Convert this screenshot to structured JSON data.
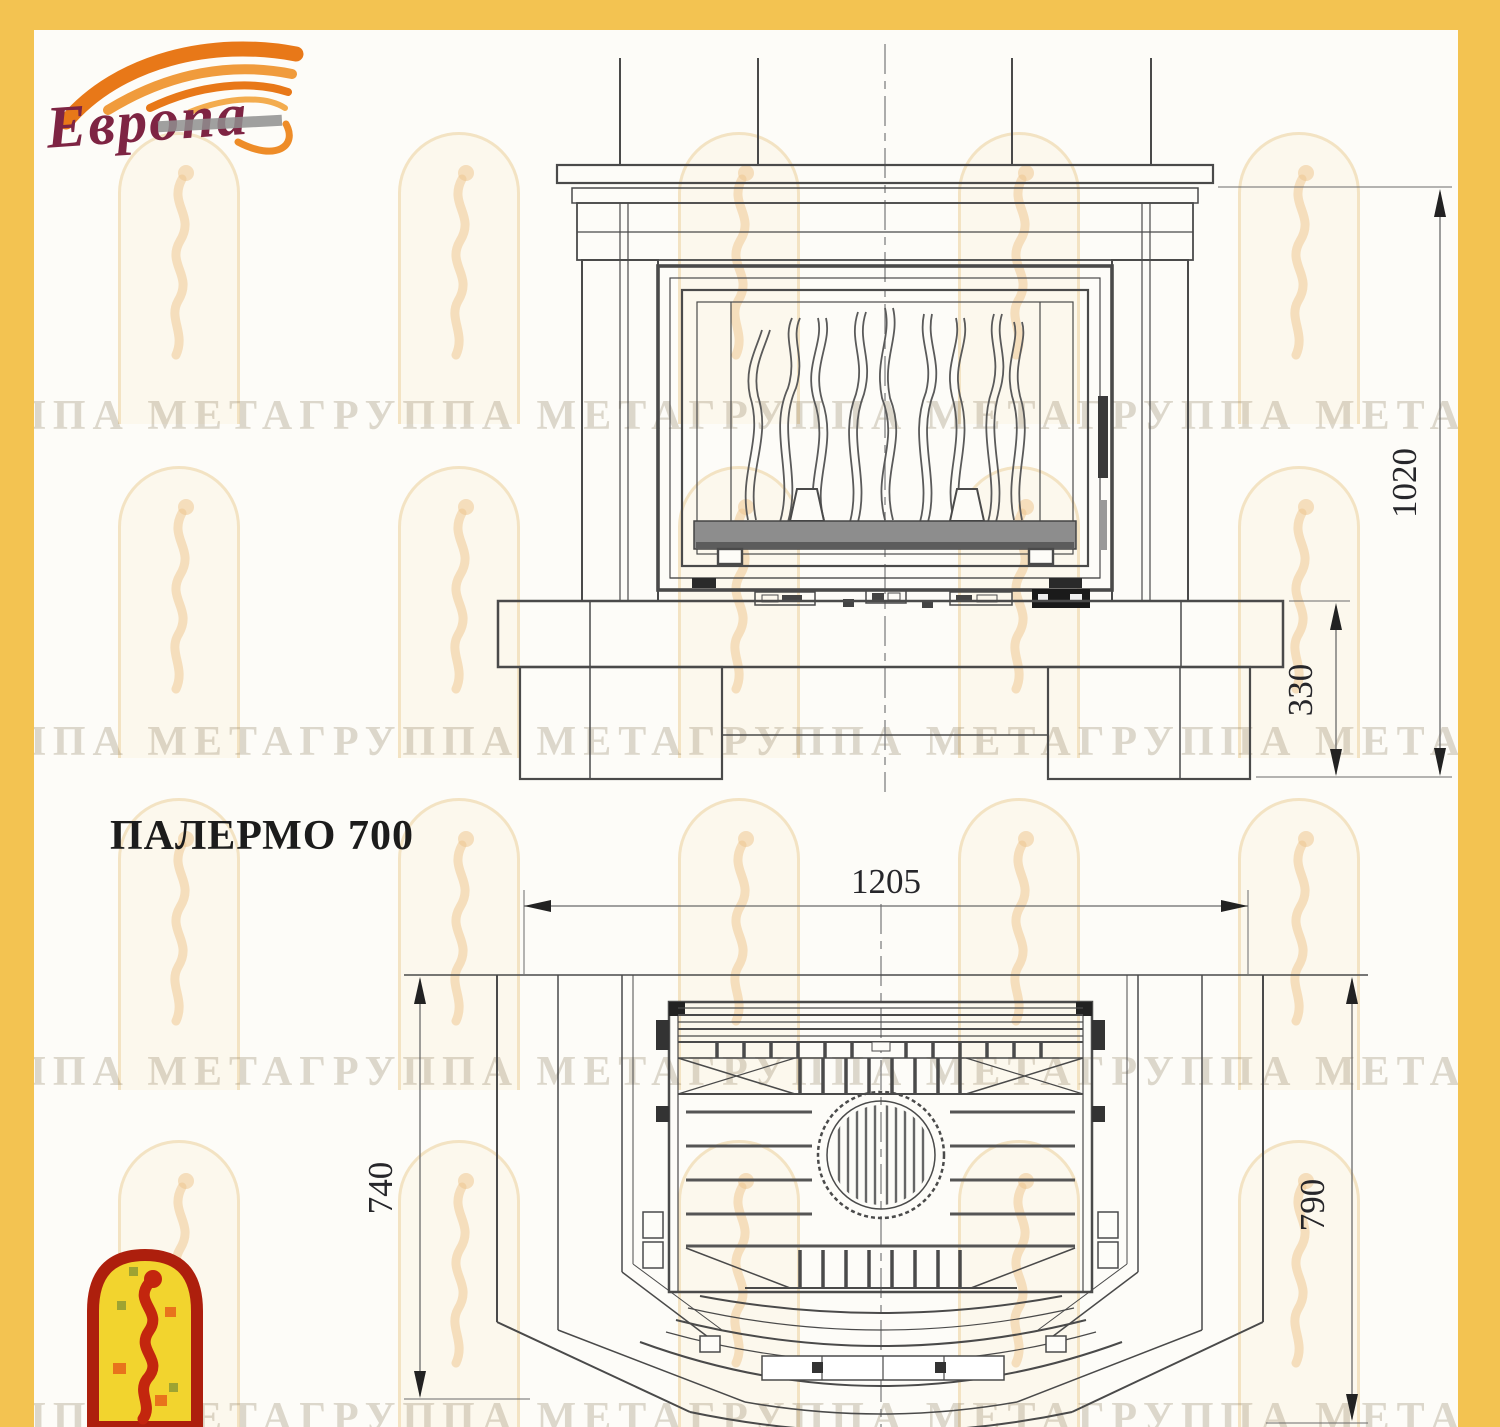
{
  "page": {
    "background": "#FDFCF8",
    "border_color": "#F3C351"
  },
  "logo": {
    "brand": "Европа"
  },
  "title": "ПАЛЕРМО 700",
  "watermark": {
    "unit": "ГРУППА МЕТА",
    "repeat": 6
  },
  "drawings": {
    "front_view": {
      "label": "front-elevation",
      "dimensions": {
        "total_height_mm": "1020",
        "base_height_mm": "330"
      }
    },
    "plan_view": {
      "label": "top-plan",
      "dimensions": {
        "width_mm": "1205",
        "depth_left_mm": "740",
        "depth_right_mm": "790"
      }
    }
  },
  "icons": {
    "logo_flame": "flame-swoosh-icon",
    "corner_emblem": "flame-dancer-arch-icon"
  },
  "colors": {
    "line": "#4A4A4A",
    "logo_maroon": "#7E2443",
    "logo_orange": "#E87818",
    "emblem_red": "#AD1F0D",
    "emblem_yellow": "#F2D42E",
    "grill_gray": "#8D8D8D"
  }
}
